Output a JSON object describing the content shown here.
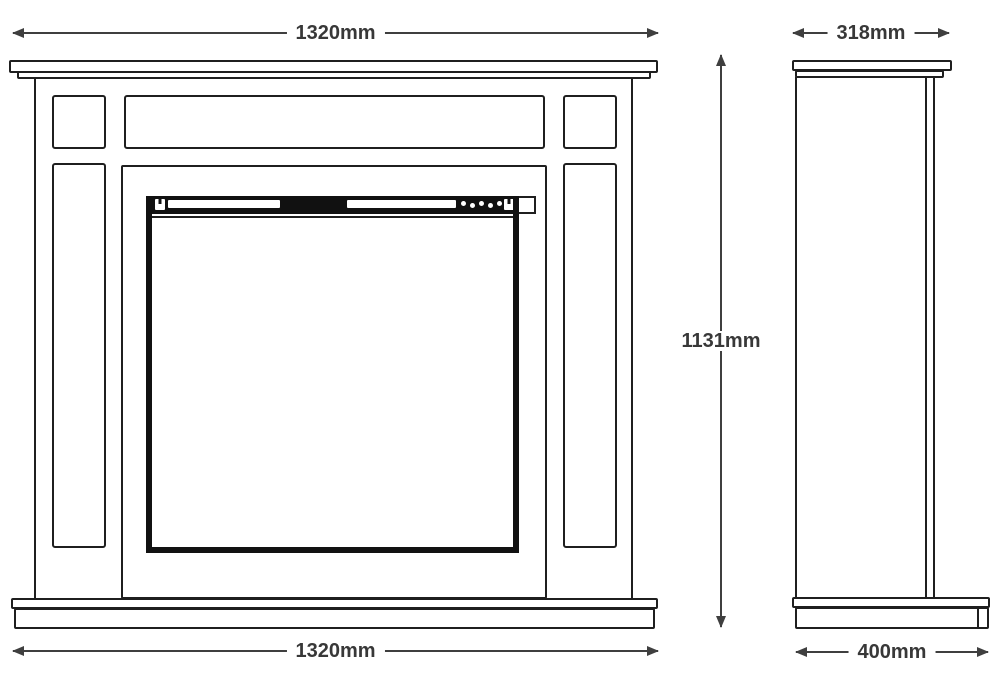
{
  "dimensions": {
    "front_width_top": "1320mm",
    "front_width_bottom": "1320mm",
    "overall_height": "1131mm",
    "depth_top": "318mm",
    "depth_base": "400mm"
  },
  "colors": {
    "background": "#ffffff",
    "drawing_line": "#1f1f1f",
    "insert_black": "#111111",
    "dimension_gray": "#3f3f3f"
  }
}
